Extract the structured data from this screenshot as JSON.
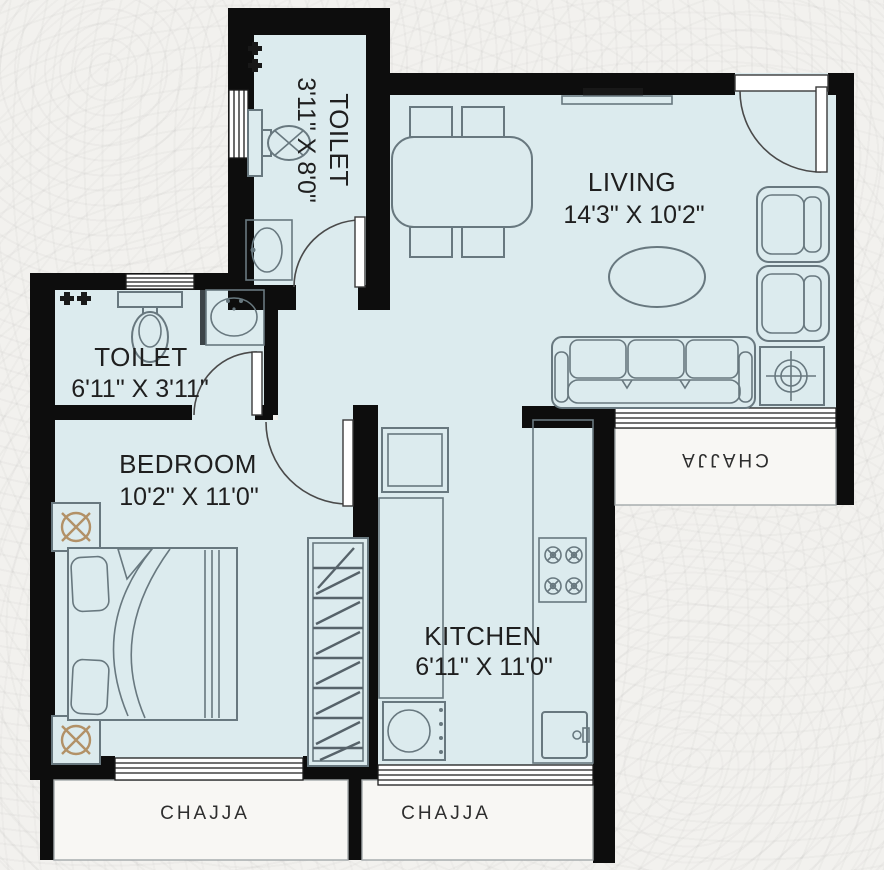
{
  "rooms": {
    "toilet_top": {
      "label": "TOILET",
      "dims": "3'11\" X 8'0\""
    },
    "toilet_mid": {
      "label": "TOILET",
      "dims": "6'11\" X 3'11\""
    },
    "living": {
      "label": "LIVING",
      "dims": "14'3\" X 10'2\""
    },
    "bedroom": {
      "label": "BEDROOM",
      "dims": "10'2\" X 11'0\""
    },
    "kitchen": {
      "label": "KITCHEN",
      "dims": "6'11\" X 11'0\""
    }
  },
  "balconies": {
    "bedroom": {
      "label": "CHAJJA"
    },
    "kitchen": {
      "label": "CHAJJA"
    },
    "living": {
      "label": "CHAJJA"
    }
  },
  "icons": {
    "wc-icon": "toilet seat with tank",
    "washbasin-icon": "oval basin on counter",
    "shower-tap-icon": "dark tap valves",
    "gas-stove-icon": "four burner circles with cross",
    "fridge-icon": "box with handle",
    "washing-unit-icon": "box with circle",
    "planter-icon": "circle with X cross"
  },
  "colors": {
    "wall": "#0d0d0d",
    "floor": "#dcebee",
    "line": "#68787f",
    "accent": "#b29167",
    "chajja": "#f8f7f4",
    "label": "#1f1f1f",
    "bg": "#f2f1ee"
  }
}
